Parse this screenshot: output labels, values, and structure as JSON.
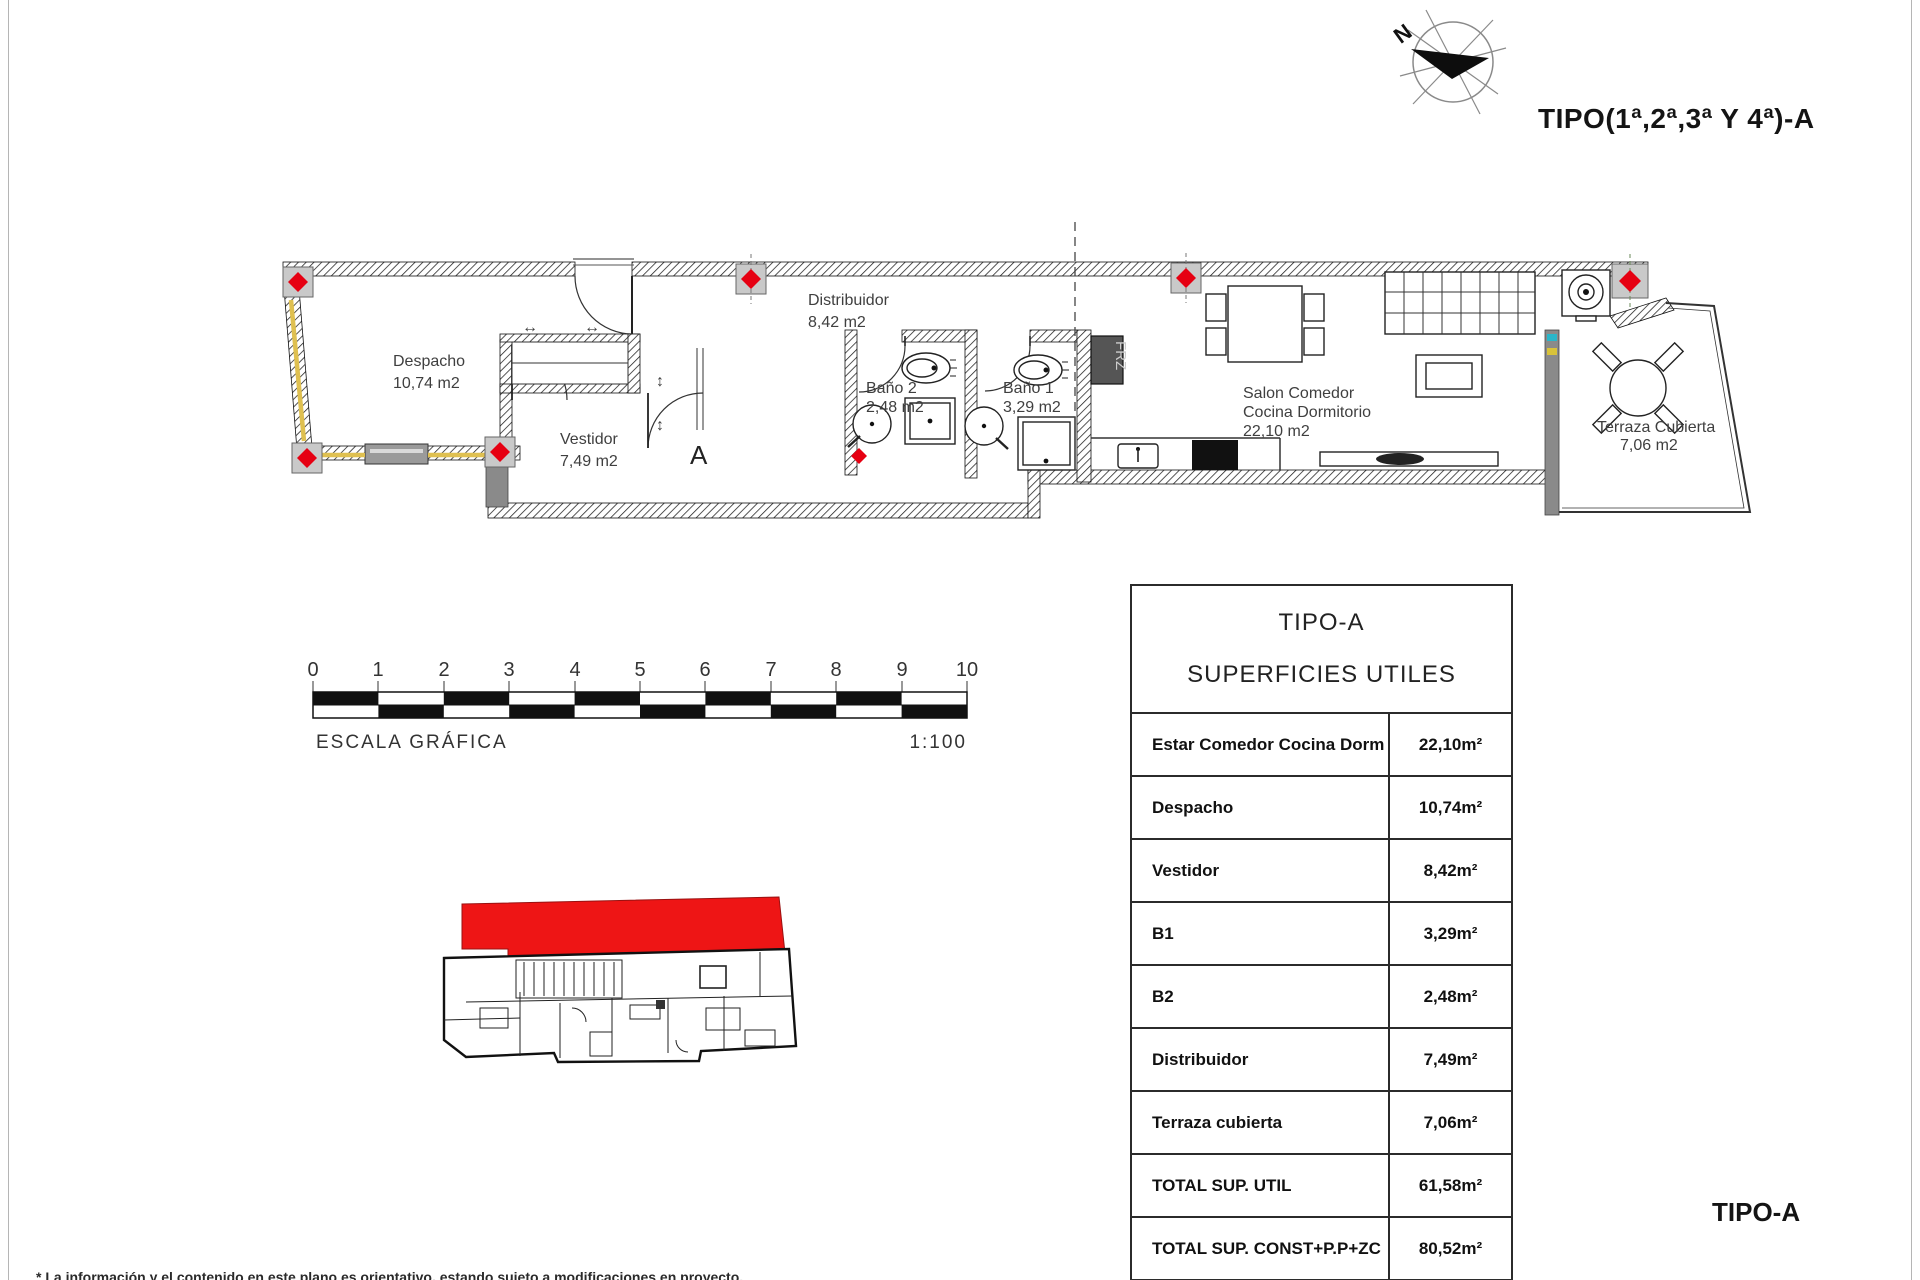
{
  "header": {
    "title": "TIPO(1ª,2ª,3ª Y 4ª)-A",
    "north_label": "N"
  },
  "plan": {
    "rooms": {
      "despacho": {
        "name": "Despacho",
        "area": "10,74 m2"
      },
      "vestidor": {
        "name": "Vestidor",
        "area": "7,49 m2"
      },
      "distribuidor": {
        "name": "Distribuidor",
        "area": "8,42 m2"
      },
      "bano2": {
        "name": "Baño 2",
        "area": "2,48 m2"
      },
      "bano1": {
        "name": "Baño 1",
        "area": "3,29 m2"
      },
      "salon": {
        "line1": "Salon Comedor",
        "line2": "Cocina Dormitorio",
        "area": "22,10 m2"
      },
      "terraza": {
        "name": "Terraza Cubierta",
        "area": "7,06 m2"
      }
    },
    "section_marker": "A",
    "fridge_label": "FRZ",
    "symbols": {
      "slide_h": "↔",
      "slide_v": "↕"
    },
    "colors": {
      "marker_red": "#e60012",
      "accent_yellow": "#dfc050",
      "wall_gray": "#8a8a8a",
      "highlight_red": "#ee1515"
    }
  },
  "scale_bar": {
    "ticks": [
      "0",
      "1",
      "2",
      "3",
      "4",
      "5",
      "6",
      "7",
      "8",
      "9",
      "10"
    ],
    "label": "ESCALA GRÁFICA",
    "ratio": "1:100"
  },
  "table": {
    "title": "TIPO-A",
    "subtitle": "SUPERFICIES UTILES",
    "rows": [
      {
        "label": "Estar Comedor Cocina Dorm",
        "value": "22,10m²"
      },
      {
        "label": "Despacho",
        "value": "10,74m²"
      },
      {
        "label": "Vestidor",
        "value": "8,42m²"
      },
      {
        "label": "B1",
        "value": "3,29m²"
      },
      {
        "label": "B2",
        "value": "2,48m²"
      },
      {
        "label": "Distribuidor",
        "value": "7,49m²"
      },
      {
        "label": "Terraza cubierta",
        "value": "7,06m²"
      },
      {
        "label": "TOTAL SUP. UTIL",
        "value": "61,58m²"
      },
      {
        "label": "TOTAL SUP. CONST+P.P+ZC",
        "value": "80,52m²"
      }
    ]
  },
  "footer": {
    "type_label": "TIPO-A",
    "disclaimer": "* La información y el contenido en este plano es orientativo, estando sujeto a modificaciones en proyecto."
  }
}
